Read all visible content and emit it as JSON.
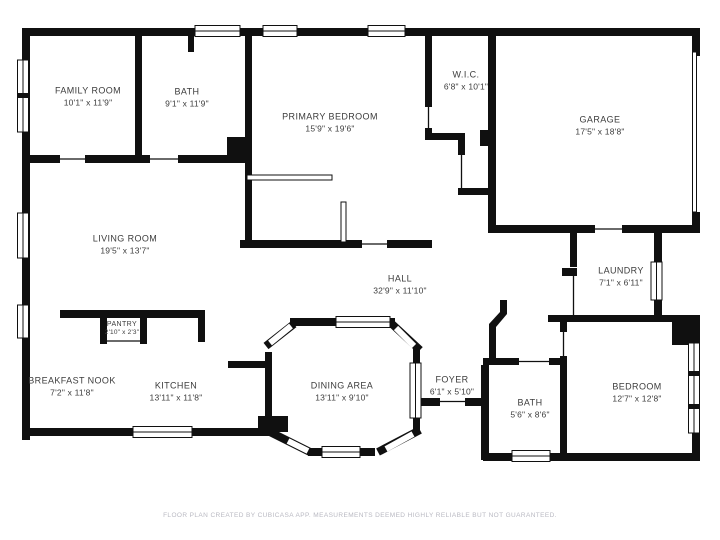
{
  "plan": {
    "rooms": [
      {
        "name": "FAMILY ROOM",
        "dims": "10'1\" x 11'9\""
      },
      {
        "name": "BATH",
        "dims": "9'1\" x 11'9\""
      },
      {
        "name": "PRIMARY BEDROOM",
        "dims": "15'9\" x 19'6\""
      },
      {
        "name": "W.I.C.",
        "dims": "6'8\" x 10'1\""
      },
      {
        "name": "GARAGE",
        "dims": "17'5\" x 18'8\""
      },
      {
        "name": "LIVING ROOM",
        "dims": "19'5\" x 13'7\""
      },
      {
        "name": "HALL",
        "dims": "32'9\" x 11'10\""
      },
      {
        "name": "LAUNDRY",
        "dims": "7'1\" x 6'11\""
      },
      {
        "name": "PANTRY",
        "dims": "2'10\" x 2'3\""
      },
      {
        "name": "BREAKFAST NOOK",
        "dims": "7'2\" x 11'8\""
      },
      {
        "name": "KITCHEN",
        "dims": "13'11\" x 11'8\""
      },
      {
        "name": "DINING AREA",
        "dims": "13'11\" x 9'10\""
      },
      {
        "name": "FOYER",
        "dims": "6'1\" x 5'10\""
      },
      {
        "name": "BATH",
        "dims": "5'6\" x 8'6\""
      },
      {
        "name": "BEDROOM",
        "dims": "12'7\" x 12'8\""
      }
    ],
    "footer": "FLOOR PLAN CREATED BY CUBICASA APP. MEASUREMENTS DEEMED HIGHLY RELIABLE BUT NOT GUARANTEED.",
    "colors": {
      "wall": "#101010",
      "background": "#ffffff",
      "label": "#3c3c3c",
      "footer": "#b9b9c2"
    }
  }
}
